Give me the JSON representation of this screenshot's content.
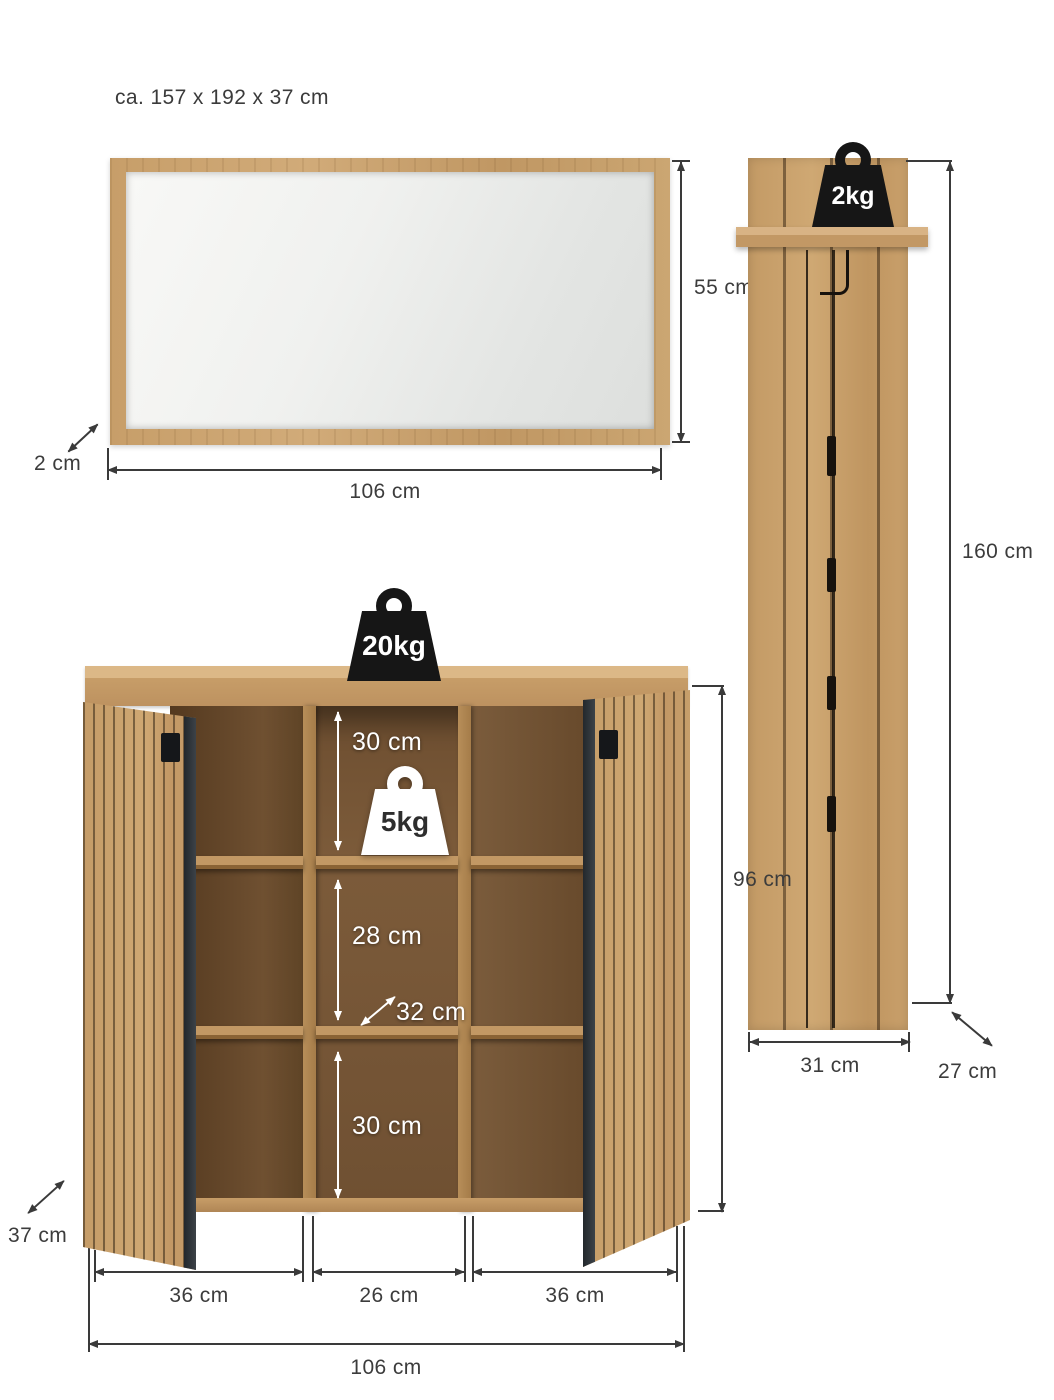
{
  "title": "ca. 157 x 192 x 37 cm",
  "mirror": {
    "height": "55 cm",
    "width": "106 cm",
    "depth": "2 cm"
  },
  "panel": {
    "max_load": "2kg",
    "height": "160 cm",
    "width": "31 cm",
    "depth": "27 cm"
  },
  "cabinet": {
    "top_max_load": "20kg",
    "shelf_max_load": "5kg",
    "inner_top_height": "30 cm",
    "inner_middle_height": "28 cm",
    "inner_bottom_height": "30 cm",
    "inner_depth": "32 cm",
    "height": "96 cm",
    "depth": "37 cm",
    "section_left_width": "36 cm",
    "section_middle_width": "26 cm",
    "section_right_width": "36 cm",
    "width": "106 cm"
  },
  "colors": {
    "wood_light": "#c9a06d",
    "wood_interior": "#6f5032",
    "dimension_line": "#3a3a3a",
    "weight_black": "#161616",
    "weight_white": "#ffffff",
    "door_edge": "#2e343a"
  }
}
